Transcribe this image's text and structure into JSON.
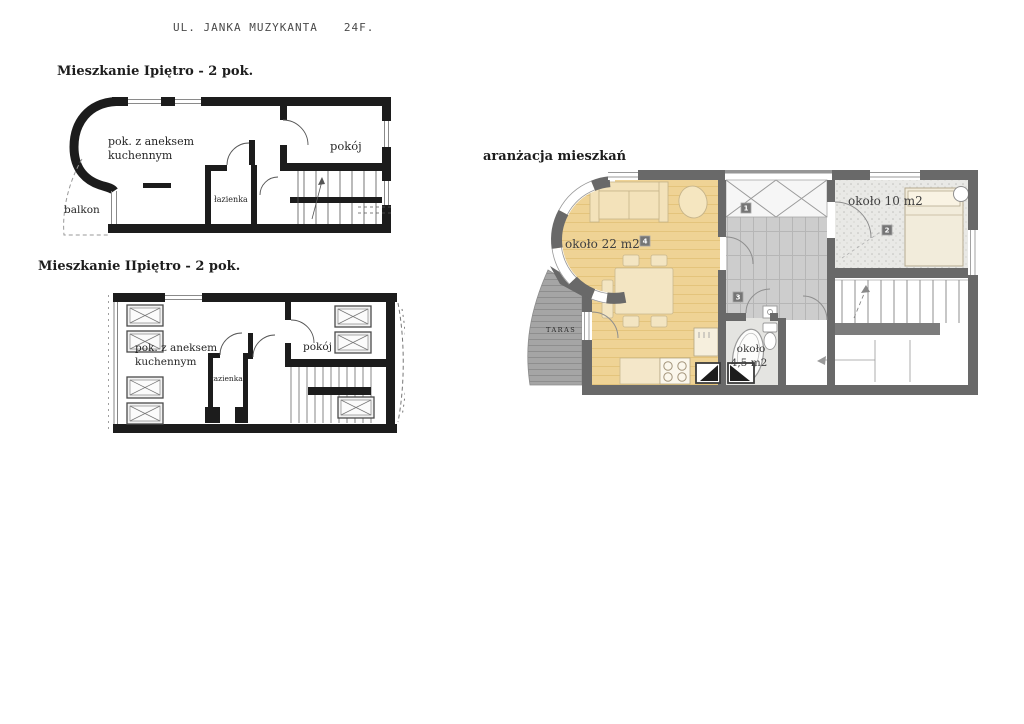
{
  "header": {
    "street": "UL. JANKA MUZYKANTA",
    "number": "24F."
  },
  "floor1": {
    "title": "Mieszkanie Ipiętro - 2 pok.",
    "labels": {
      "living_line1": "pok. z aneksem",
      "living_line2": "kuchennym",
      "bathroom": "łazienka",
      "room": "pokój",
      "balcony": "balkon"
    }
  },
  "floor2": {
    "title": "Mieszkanie IIpiętro - 2 pok.",
    "labels": {
      "living_line1": "pok. z aneksem",
      "living_line2": "kuchennym",
      "bathroom": "łazienka",
      "room": "pokój"
    }
  },
  "arrangement": {
    "title": "aranżacja mieszkań",
    "living_area": "około 22 m2",
    "living_badge": "4",
    "bedroom_area": "około 10 m2",
    "bedroom_badge": "2",
    "bathroom_area_line1": "około",
    "bathroom_area_line2": "4,5 m2",
    "hall_badge": "1",
    "corridor_badge": "3",
    "terrace_label": "TARAS"
  },
  "colors": {
    "wall_black": "#1c1c1c",
    "wall_gray": "#696969",
    "floor_yellow": "#efd395",
    "furniture_cream": "#f3e2ba",
    "corridor_gray": "#cdcdcd",
    "bedroom_gray": "#e9e9e6",
    "terrace_gray": "#a5a5a5",
    "badge_gray": "#757575"
  }
}
